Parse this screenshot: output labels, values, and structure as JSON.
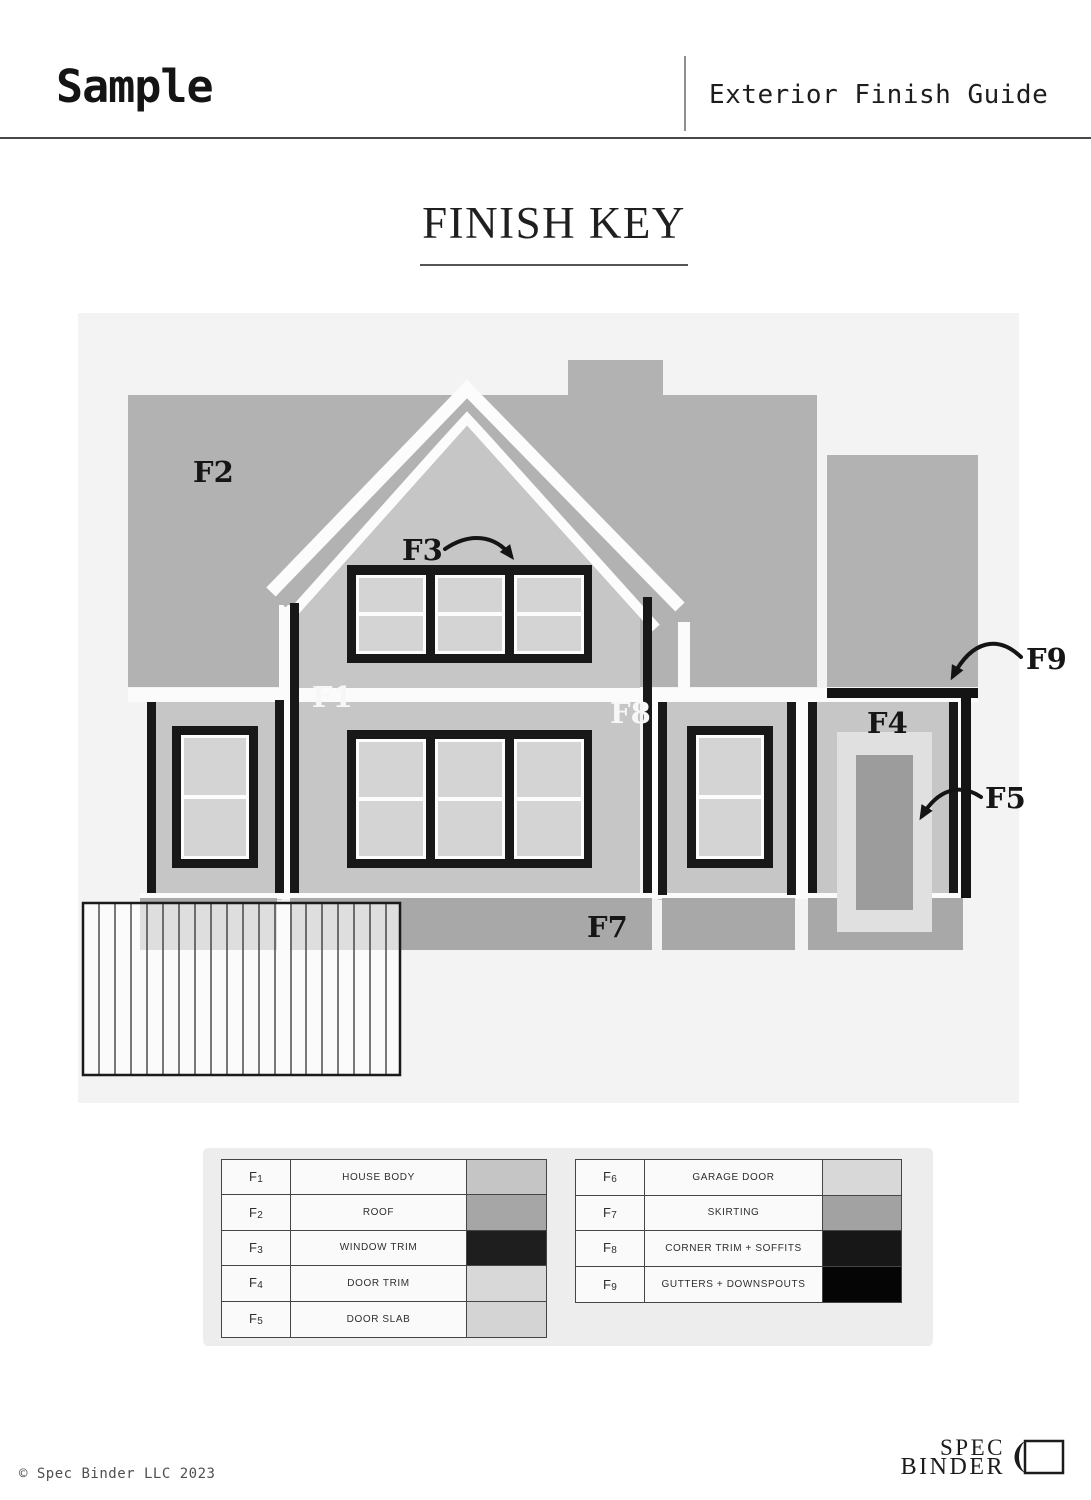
{
  "header": {
    "title": "Sample",
    "subtitle": "Exterior Finish Guide"
  },
  "finish_key": {
    "title": "FINISH KEY"
  },
  "house_labels": {
    "f1": "F1",
    "f2": "F2",
    "f3": "F3",
    "f4": "F4",
    "f5": "F5",
    "f7": "F7",
    "f8": "F8",
    "f9": "F9"
  },
  "legend": {
    "left_rows": [
      {
        "code": "F1",
        "label": "HOUSE BODY",
        "color": "#c5c5c5"
      },
      {
        "code": "F2",
        "label": "ROOF",
        "color": "#a6a6a6"
      },
      {
        "code": "F3",
        "label": "WINDOW TRIM",
        "color": "#1e1e1e"
      },
      {
        "code": "F4",
        "label": "DOOR TRIM",
        "color": "#d8d8d8"
      },
      {
        "code": "F5",
        "label": "DOOR SLAB",
        "color": "#d4d4d4"
      }
    ],
    "right_rows": [
      {
        "code": "F6",
        "label": "GARAGE DOOR",
        "color": "#d8d8d8"
      },
      {
        "code": "F7",
        "label": "SKIRTING",
        "color": "#a2a2a2"
      },
      {
        "code": "F8",
        "label": "CORNER TRIM + SOFFITS",
        "color": "#171717"
      },
      {
        "code": "F9",
        "label": "GUTTERS + DOWNSPOUTS",
        "color": "#050505"
      }
    ]
  },
  "footer": {
    "copyright": "© Spec Binder LLC 2023",
    "logo_top": "SPEC",
    "logo_bottom": "BINDER"
  }
}
